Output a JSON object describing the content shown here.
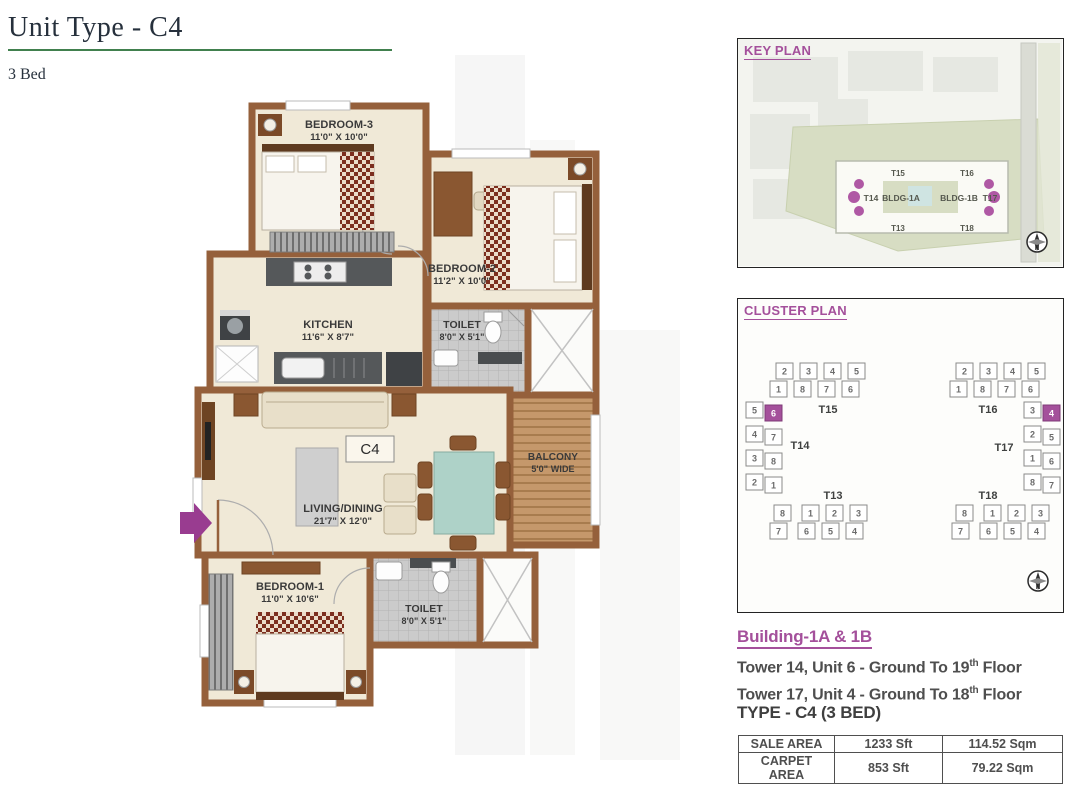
{
  "header": {
    "title": "Unit Type - C4",
    "subtitle": "3 Bed"
  },
  "colors": {
    "accent_magenta": "#A4509B",
    "accent_green": "#41804E",
    "wall_brown": "#95603B"
  },
  "floor_plan": {
    "unit_marker": "C4",
    "rooms": {
      "bedroom3": {
        "name": "BEDROOM-3",
        "dims": "11'0\" X 10'0\""
      },
      "bedroom2": {
        "name": "BEDROOM-2",
        "dims": "11'2\" X 10'0\""
      },
      "kitchen": {
        "name": "KITCHEN",
        "dims": "11'6\" X 8'7\""
      },
      "toilet2": {
        "name": "TOILET",
        "dims": "8'0\" X 5'1\""
      },
      "living": {
        "name": "LIVING/DINING",
        "dims": "21'7\" X 12'0\""
      },
      "balcony": {
        "name": "BALCONY",
        "dims": "5'0\" WIDE"
      },
      "bedroom1": {
        "name": "BEDROOM-1",
        "dims": "11'0\" X 10'6\""
      },
      "toilet1": {
        "name": "TOILET",
        "dims": "8'0\" X 5'1\""
      }
    }
  },
  "key_plan": {
    "title": "KEY PLAN",
    "labels": {
      "t15": "T15",
      "t16": "T16",
      "t14": "T14",
      "bldg1a": "BLDG-1A",
      "bldg1b": "BLDG-1B",
      "t17": "T17",
      "t13": "T13",
      "t18": "T18"
    },
    "compass": "N"
  },
  "cluster_plan": {
    "title": "CLUSTER PLAN",
    "left": {
      "top_tower": "T15",
      "top_row1": [
        "2",
        "3",
        "4",
        "5"
      ],
      "top_row2": [
        "1",
        "8",
        "7",
        "6"
      ],
      "wing_tower": "T14",
      "wing_outer": [
        "5",
        "4",
        "3",
        "2"
      ],
      "wing_inner": [
        "6",
        "7",
        "8",
        "1"
      ],
      "bottom_tower": "T13",
      "bottom_row1": [
        "8",
        "1",
        "2",
        "3"
      ],
      "bottom_row2": [
        "7",
        "6",
        "5",
        "4"
      ],
      "highlight_unit": "6"
    },
    "right": {
      "top_tower": "T16",
      "top_row1": [
        "2",
        "3",
        "4",
        "5"
      ],
      "top_row2": [
        "1",
        "8",
        "7",
        "6"
      ],
      "wing_tower": "T17",
      "wing_inner": [
        "3",
        "2",
        "1",
        "8"
      ],
      "wing_outer": [
        "4",
        "5",
        "6",
        "7"
      ],
      "bottom_tower": "T18",
      "bottom_row1": [
        "8",
        "1",
        "2",
        "3"
      ],
      "bottom_row2": [
        "7",
        "6",
        "5",
        "4"
      ],
      "highlight_unit": "4"
    },
    "compass": "N"
  },
  "building_info": {
    "heading": "Building-1A & 1B",
    "lines": [
      {
        "prefix": "Tower 14, Unit 6 - Ground To 19",
        "sup": "th",
        "suffix": " Floor"
      },
      {
        "prefix": "Tower 17, Unit 4 - Ground To 18",
        "sup": "th",
        "suffix": " Floor"
      }
    ],
    "type_heading": "TYPE - C4 (3 BED)"
  },
  "area_table": {
    "rows": [
      [
        "SALE AREA",
        "1233 Sft",
        "114.52 Sqm"
      ],
      [
        "CARPET AREA",
        "853 Sft",
        "79.22 Sqm"
      ]
    ]
  }
}
